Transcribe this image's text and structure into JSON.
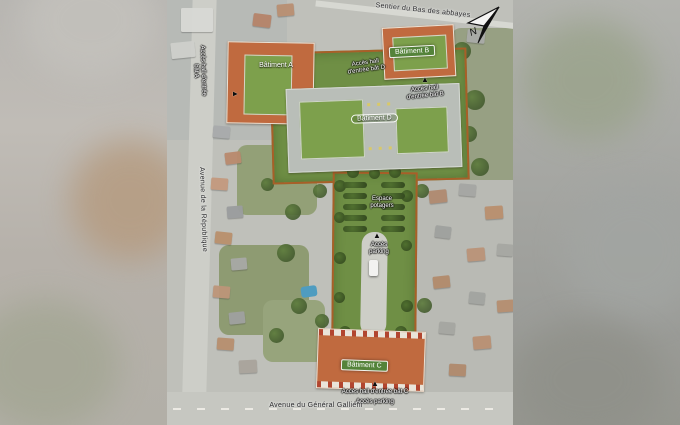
{
  "map": {
    "streets": {
      "top": "Sentier du Bas des abbayes",
      "left": "Avenue de la République",
      "bottom": "Avenue du Général Galliéni"
    },
    "compass_label": "N",
    "buildings": {
      "a": "Bâtiment A",
      "b": "Bâtiment B",
      "c": "Bâtiment C",
      "d": "Bâtiment D"
    },
    "access": {
      "hall_a": "Accès hall d'entrée bât A",
      "hall_b": "Accès hall d'entrée bât B",
      "hall_c": "Accès hall d'entrée bât C",
      "hall_d": "Accès hall d'entrée bât D",
      "parking_mid": "Accès parking",
      "parking_bottom": "Accès parking"
    },
    "areas": {
      "garden": "Espace potagers"
    },
    "marker_arrow": "▲",
    "colors": {
      "site_green": "#6f8f45",
      "building_orange": "#c06a3f",
      "badge_green": "#54833a",
      "boundary_orange": "#a85f28"
    }
  }
}
